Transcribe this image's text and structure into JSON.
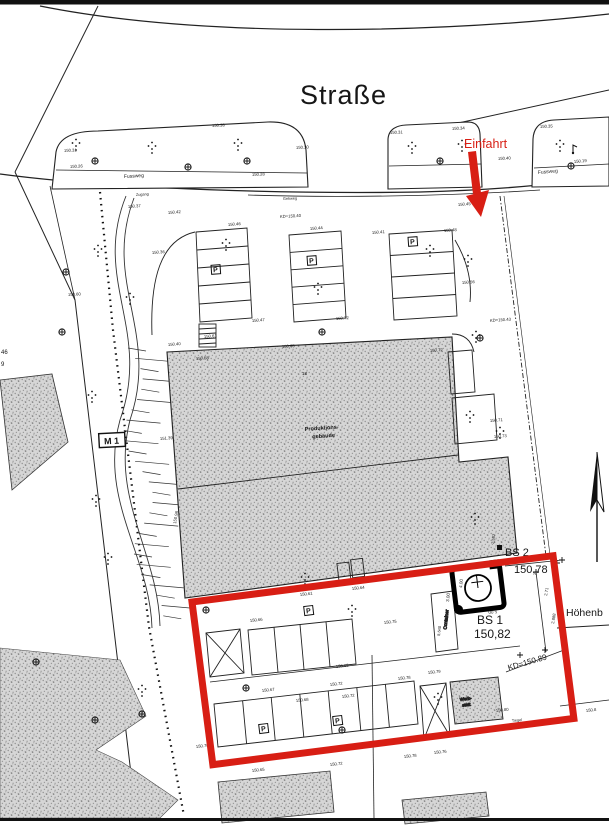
{
  "page": {
    "type_label": "Lageplan (site plan)"
  },
  "colors": {
    "accent_red": "#d81e14",
    "ink": "#161616",
    "building_gray": "#c9c9c9",
    "background": "#ffffff"
  },
  "street": {
    "name": "Straße",
    "entrance_label": "Einfahrt"
  },
  "survey": {
    "bs1_name": "BS 1",
    "bs1_height": "150,82",
    "bs2_name": "BS 2",
    "bs2_height": "150,78",
    "kd_label": "KD=150.89",
    "height_ref_label": "Höhenb",
    "m1_label": "M 1",
    "edge_fragment_top": "46",
    "edge_fragment_bottom": "9"
  },
  "building": {
    "line1": "Produktions-",
    "line2": "gebäude",
    "inner_mark": "18"
  },
  "site": {
    "container_label": "Container",
    "werkstatt_line1": "Werk-",
    "werkstatt_line2": "statt",
    "parking_symbol": "P"
  },
  "p_positions": [
    [
      216,
      272,
      -4
    ],
    [
      312,
      263,
      -4
    ],
    [
      413,
      244,
      -4
    ],
    [
      309,
      613,
      -7
    ],
    [
      264,
      731,
      -7
    ],
    [
      338,
      723,
      -7
    ]
  ],
  "annotations": [
    {
      "t": "150.31",
      "x": 64,
      "y": 152,
      "r": -3
    },
    {
      "t": "150.26",
      "x": 70,
      "y": 168,
      "r": -3
    },
    {
      "t": "150.38",
      "x": 212,
      "y": 127,
      "r": -3
    },
    {
      "t": "150.30",
      "x": 296,
      "y": 149,
      "r": -3
    },
    {
      "t": "150.28",
      "x": 252,
      "y": 176,
      "r": -3
    },
    {
      "t": "Fussweg",
      "x": 124,
      "y": 178,
      "r": -3,
      "s": 5
    },
    {
      "t": "150.31",
      "x": 390,
      "y": 134,
      "r": -3
    },
    {
      "t": "150.34",
      "x": 452,
      "y": 130,
      "r": -3
    },
    {
      "t": "150.40",
      "x": 498,
      "y": 160,
      "r": -3
    },
    {
      "t": "150.35",
      "x": 540,
      "y": 128,
      "r": -3
    },
    {
      "t": "Fussweg",
      "x": 538,
      "y": 174,
      "r": -5,
      "s": 5
    },
    {
      "t": "150.19",
      "x": 574,
      "y": 163,
      "r": -5
    },
    {
      "t": "Gehweg",
      "x": 283,
      "y": 200,
      "r": -2,
      "s": 3.8
    },
    {
      "t": "Zugang",
      "x": 136,
      "y": 196,
      "r": -3,
      "s": 3.8
    },
    {
      "t": "KD=150.40",
      "x": 280,
      "y": 218,
      "r": -3
    },
    {
      "t": "150.42",
      "x": 168,
      "y": 214,
      "r": -4
    },
    {
      "t": "150.37",
      "x": 128,
      "y": 208,
      "r": -4
    },
    {
      "t": "150.46",
      "x": 228,
      "y": 226,
      "r": -4
    },
    {
      "t": "150.44",
      "x": 310,
      "y": 230,
      "r": -4
    },
    {
      "t": "150.41",
      "x": 372,
      "y": 234,
      "r": -4
    },
    {
      "t": "150.48",
      "x": 444,
      "y": 232,
      "r": -4
    },
    {
      "t": "150.36",
      "x": 152,
      "y": 254,
      "r": -4
    },
    {
      "t": "150.60",
      "x": 68,
      "y": 296,
      "r": -3
    },
    {
      "t": "150.47",
      "x": 252,
      "y": 322,
      "r": -4
    },
    {
      "t": "150.61",
      "x": 204,
      "y": 338,
      "r": -4
    },
    {
      "t": "150.72",
      "x": 336,
      "y": 320,
      "r": -4
    },
    {
      "t": "150.65",
      "x": 282,
      "y": 348,
      "r": -4
    },
    {
      "t": "KD=150.43",
      "x": 490,
      "y": 322,
      "r": -4
    },
    {
      "t": "150.56",
      "x": 462,
      "y": 284,
      "r": -4
    },
    {
      "t": "150.45",
      "x": 458,
      "y": 206,
      "r": -4
    },
    {
      "t": "150.72",
      "x": 430,
      "y": 352,
      "r": -4
    },
    {
      "t": "150.71",
      "x": 490,
      "y": 422,
      "r": -4
    },
    {
      "t": "150.73",
      "x": 494,
      "y": 438,
      "r": -4
    },
    {
      "t": "150.58",
      "x": 196,
      "y": 360,
      "r": -4
    },
    {
      "t": "150.40",
      "x": 168,
      "y": 346,
      "r": -4
    },
    {
      "t": "151.39",
      "x": 160,
      "y": 440,
      "r": -4
    },
    {
      "t": "150.98",
      "x": 176,
      "y": 524,
      "r": -80
    },
    {
      "t": "150.61",
      "x": 300,
      "y": 596,
      "r": -6
    },
    {
      "t": "150.64",
      "x": 352,
      "y": 590,
      "r": -6
    },
    {
      "t": "150.66",
      "x": 250,
      "y": 622,
      "r": -6
    },
    {
      "t": "150.75",
      "x": 384,
      "y": 624,
      "r": -6
    },
    {
      "t": "150.65",
      "x": 336,
      "y": 668,
      "r": -6
    },
    {
      "t": "150.67",
      "x": 262,
      "y": 692,
      "r": -6
    },
    {
      "t": "150.72",
      "x": 330,
      "y": 686,
      "r": -6
    },
    {
      "t": "150.78",
      "x": 398,
      "y": 680,
      "r": -6
    },
    {
      "t": "150.79",
      "x": 428,
      "y": 674,
      "r": -6
    },
    {
      "t": "150.80",
      "x": 496,
      "y": 712,
      "r": -6
    },
    {
      "t": "3.00",
      "x": 449,
      "y": 602,
      "r": -84,
      "s": 4.5
    },
    {
      "t": "4.00",
      "x": 462,
      "y": 588,
      "r": -84,
      "s": 4.5
    },
    {
      "t": "5.00",
      "x": 497,
      "y": 610,
      "r": 174,
      "s": 4.5
    },
    {
      "t": "8.640",
      "x": 440,
      "y": 636,
      "r": -84,
      "s": 4
    },
    {
      "t": "2.71",
      "x": 547,
      "y": 596,
      "r": -80,
      "s": 4.2
    },
    {
      "t": "2.888",
      "x": 554,
      "y": 624,
      "r": -80,
      "s": 4.2
    },
    {
      "t": "2.587",
      "x": 494,
      "y": 544,
      "r": -82,
      "s": 4
    },
    {
      "t": "150.68",
      "x": 296,
      "y": 702,
      "r": -6
    },
    {
      "t": "150.72",
      "x": 342,
      "y": 698,
      "r": -6
    },
    {
      "t": "150.65",
      "x": 252,
      "y": 772,
      "r": -6
    },
    {
      "t": "150.72",
      "x": 330,
      "y": 766,
      "r": -6
    },
    {
      "t": "150.78",
      "x": 404,
      "y": 758,
      "r": -6
    },
    {
      "t": "150.76",
      "x": 434,
      "y": 754,
      "r": -6
    },
    {
      "t": "Tiegel",
      "x": 512,
      "y": 722,
      "r": -6,
      "s": 3.8
    },
    {
      "t": "150.8",
      "x": 586,
      "y": 712,
      "r": -6
    },
    {
      "t": "150.70",
      "x": 196,
      "y": 748,
      "r": -6
    }
  ]
}
